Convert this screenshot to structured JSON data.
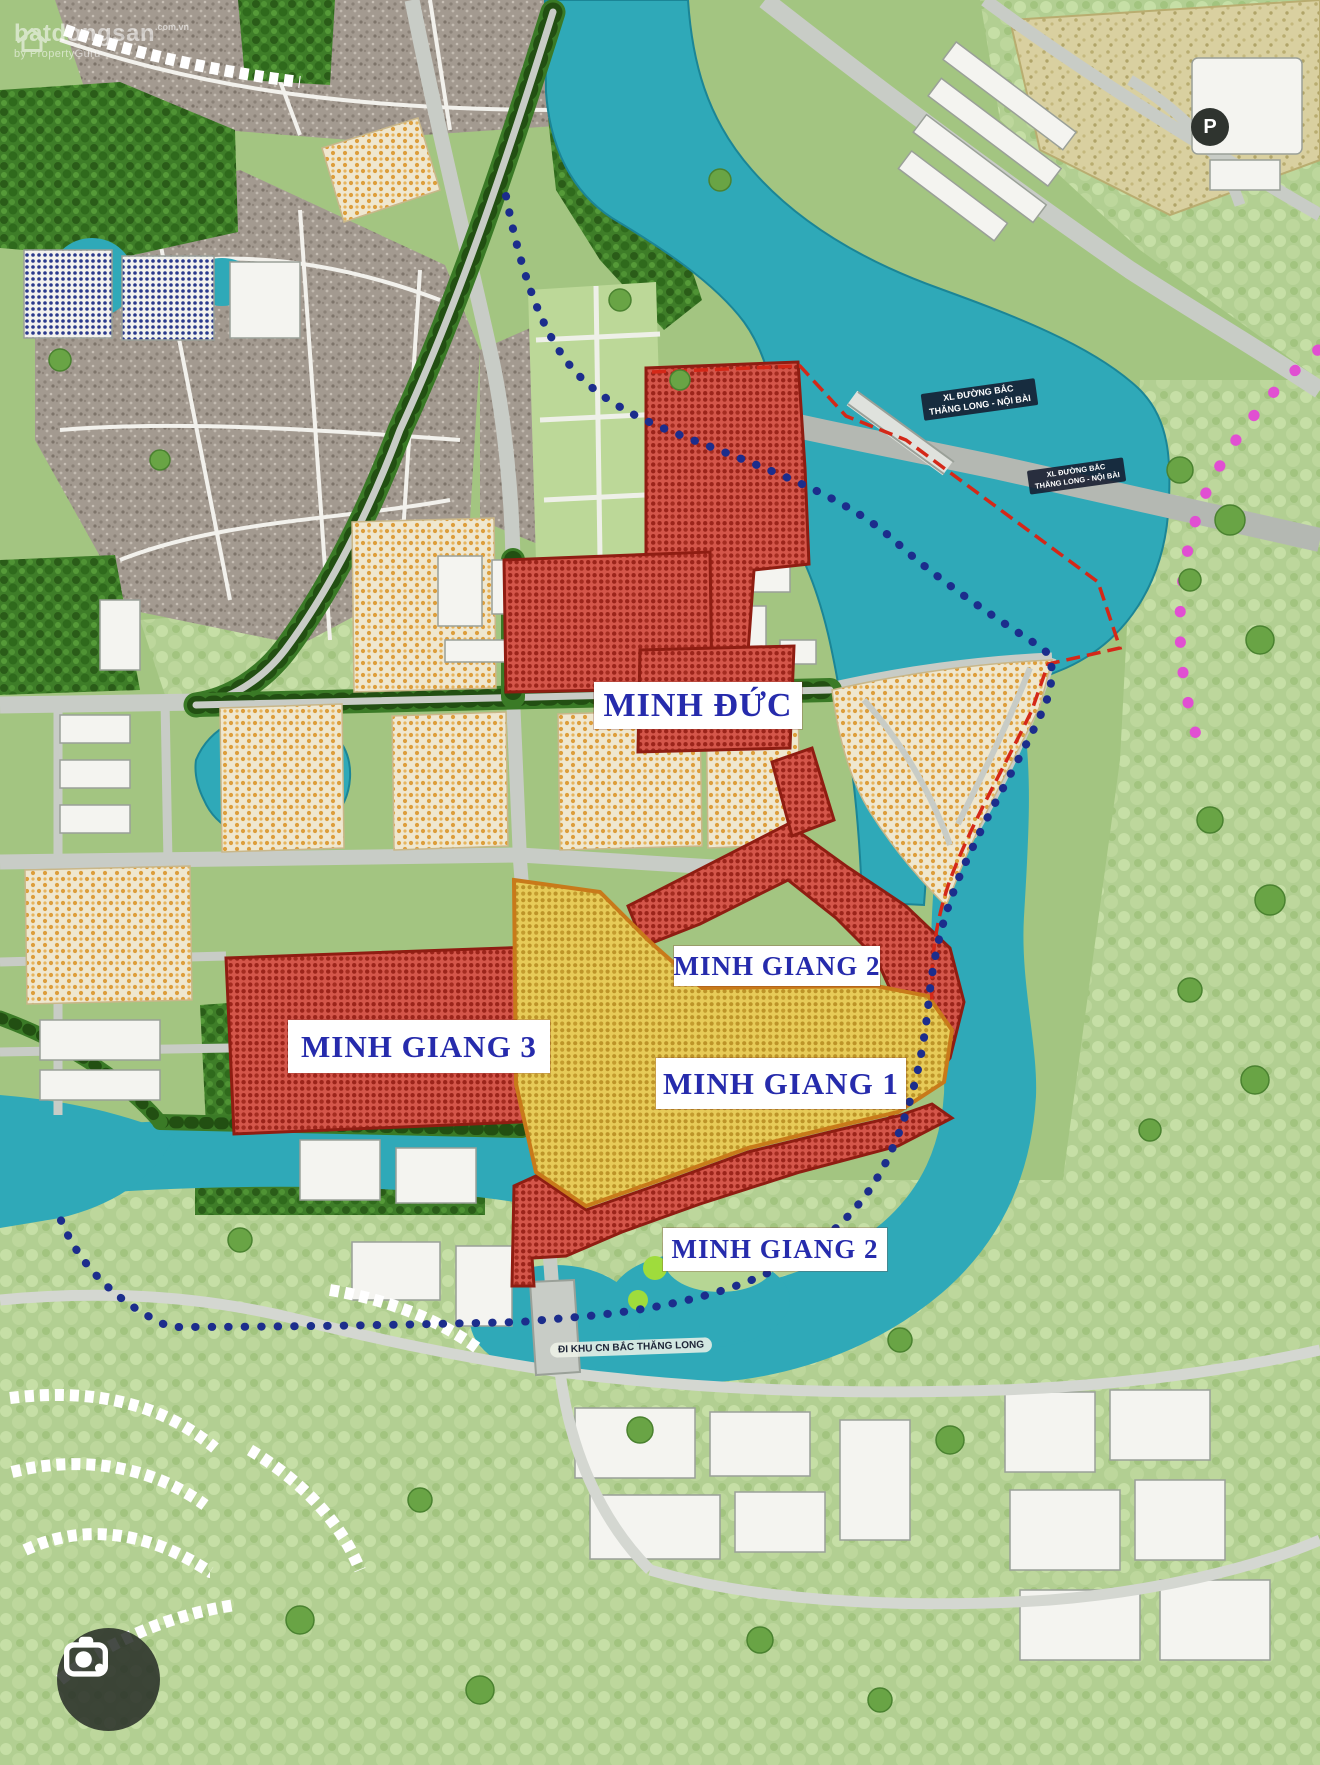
{
  "watermark": {
    "brand": "batdongsan",
    "suffix": ".com.vn",
    "tagline": "by PropertyGuru"
  },
  "map": {
    "zone_labels": {
      "minh_duc": "MINH ĐỨC",
      "minh_giang_3": "MINH GIANG 3",
      "minh_giang_1": "MINH GIANG 1",
      "minh_giang_2_upper": "MINH GIANG 2",
      "minh_giang_2_lower": "MINH GIANG 2"
    },
    "road_labels": {
      "expressway_nw": {
        "line1": "XL ĐƯỜNG BẮC",
        "line2": "THĂNG LONG - NỘI BÀI"
      },
      "expressway_se": {
        "line1": "XL ĐƯỜNG BẮC",
        "line2": "THĂNG LONG - NỘI BÀI"
      },
      "industrial": "ĐI KHU CN BẮC THĂNG LONG"
    },
    "markers": {
      "parking": "P"
    },
    "colors": {
      "zone_red": "#d4564a",
      "zone_yellow": "#e7cb58",
      "water": "#2fa9b8",
      "label_text": "#262bac",
      "boundary_blue": "#1c2d8c",
      "boundary_red": "#d42818",
      "magenta_dots": "#e14fd2"
    }
  }
}
